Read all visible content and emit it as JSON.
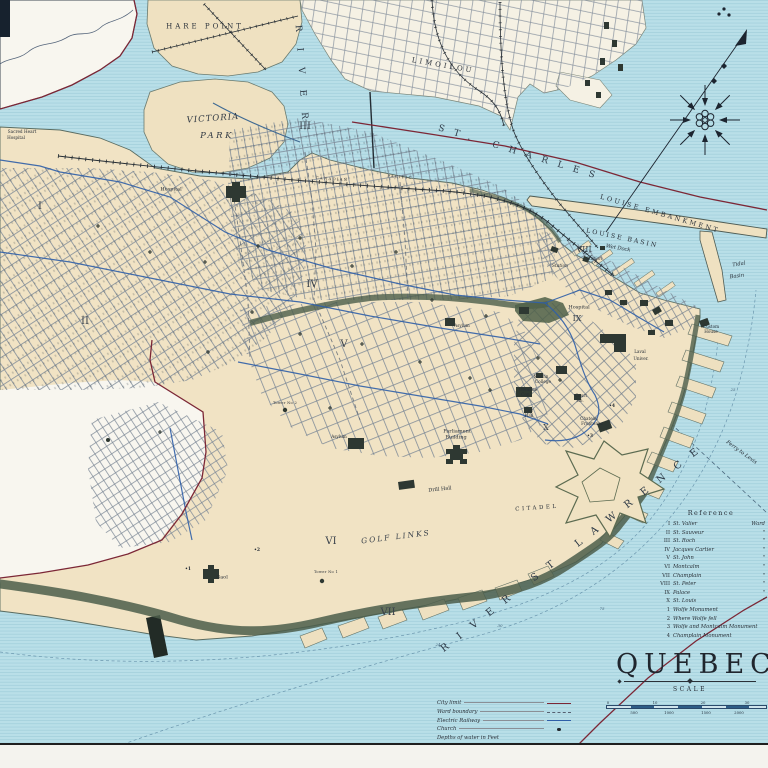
{
  "title": {
    "text": "QUEBEC",
    "scale_label": "SCALE"
  },
  "scale_bar": {
    "top_ticks": [
      "0",
      "10",
      "20",
      "30"
    ],
    "bottom_ticks": [
      "500",
      "1000",
      "1500",
      "2000"
    ]
  },
  "reference": {
    "heading": "Reference",
    "wards": [
      {
        "n": "I",
        "name": "St. Valier",
        "suffix": "Ward"
      },
      {
        "n": "II",
        "name": "St. Sauveur",
        "suffix": "\""
      },
      {
        "n": "III",
        "name": "St. Roch",
        "suffix": "\""
      },
      {
        "n": "IV",
        "name": "Jacques Cartier",
        "suffix": "\""
      },
      {
        "n": "V",
        "name": "St. John",
        "suffix": "\""
      },
      {
        "n": "VI",
        "name": "Montcalm",
        "suffix": "\""
      },
      {
        "n": "VII",
        "name": "Champlain",
        "suffix": "\""
      },
      {
        "n": "VIII",
        "name": "St. Peter",
        "suffix": "\""
      },
      {
        "n": "IX",
        "name": "Palace",
        "suffix": "\""
      },
      {
        "n": "X",
        "name": "St. Louis",
        "suffix": "\""
      }
    ],
    "monuments": [
      {
        "n": "1",
        "name": "Wolfe Monument"
      },
      {
        "n": "2",
        "name": "Where Wolfe fell"
      },
      {
        "n": "3",
        "name": "Wolfe and Montcalm Monument"
      },
      {
        "n": "4",
        "name": "Champlain Monument"
      }
    ]
  },
  "legend": {
    "items": [
      {
        "label": "City limit",
        "type": "city-limit"
      },
      {
        "label": "Ward boundary",
        "type": "ward-boundary"
      },
      {
        "label": "Electric Railway",
        "type": "electric-railway"
      },
      {
        "label": "Church",
        "type": "church"
      },
      {
        "label": "Depths of water in Feet",
        "type": "none"
      }
    ]
  },
  "colors": {
    "water": "#b9dfe8",
    "land": "#f1e3c4",
    "outside_city": "#f8f6ef",
    "electric_railway_blue": "#2f5fa8",
    "city_limit_red": "#7c2736",
    "cliff_green": "#4c5e4b",
    "ink": "#262d36"
  },
  "map": {
    "labels": [
      {
        "name": "hare-point",
        "text": "HARE POINT",
        "x": 205,
        "y": 27,
        "rot": 0,
        "cls": "place-sp"
      },
      {
        "name": "victoria-park-1",
        "text": "VICTORIA",
        "x": 213,
        "y": 119,
        "rot": -4,
        "cls": "place-it"
      },
      {
        "name": "victoria-park-2",
        "text": "PARK",
        "x": 217,
        "y": 136,
        "rot": 0,
        "cls": "place-it2"
      },
      {
        "name": "river-st-charles-1",
        "text": "RIVER",
        "x": 301,
        "y": 80,
        "rot": 86,
        "cls": "water-vert"
      },
      {
        "name": "river-st-charles-2",
        "text": "ST. CHARLES",
        "x": 521,
        "y": 154,
        "rot": 17,
        "cls": "water-lg"
      },
      {
        "name": "river-st-lawrence",
        "text": "RIVER  ST  LAWRENCE",
        "x": 575,
        "y": 547,
        "rot": -38,
        "cls": "water-xl"
      },
      {
        "name": "limoilou",
        "text": "LIMOILOU",
        "x": 443,
        "y": 66,
        "rot": 10,
        "cls": "place-sp"
      },
      {
        "name": "louise-embankment",
        "text": "LOUISE EMBANKMENT",
        "x": 660,
        "y": 214,
        "rot": 16,
        "cls": "embank"
      },
      {
        "name": "louise-basin",
        "text": "LOUISE BASIN",
        "x": 622,
        "y": 239,
        "rot": 12,
        "cls": "basin"
      },
      {
        "name": "wet-dock",
        "text": "Wet Dock",
        "x": 618,
        "y": 249,
        "rot": 10,
        "cls": "sm-it"
      },
      {
        "name": "tidal-basin-1",
        "text": "Tidal",
        "x": 739,
        "y": 265,
        "rot": -8,
        "cls": "sm-it"
      },
      {
        "name": "tidal-basin-2",
        "text": "Basin",
        "x": 737,
        "y": 277,
        "rot": -8,
        "cls": "sm-it"
      },
      {
        "name": "station-1",
        "text": "Station",
        "x": 594,
        "y": 260,
        "rot": 0,
        "cls": "tiny-it"
      },
      {
        "name": "station-2",
        "text": "Station",
        "x": 560,
        "y": 267,
        "rot": 0,
        "cls": "tiny-it"
      },
      {
        "name": "canadian-pacific-1",
        "text": "CANADIAN",
        "x": 332,
        "y": 179,
        "rot": 4,
        "cls": "rail-cap"
      },
      {
        "name": "canadian-pacific-2",
        "text": "PACIFIC",
        "x": 400,
        "y": 177,
        "rot": 4,
        "cls": "rail-cap"
      },
      {
        "name": "hospital-st-sauveur",
        "text": "Hospital",
        "x": 171,
        "y": 190,
        "rot": 0,
        "cls": "bldg"
      },
      {
        "name": "sacred-heart-1",
        "text": "Sacred Heart",
        "x": 22,
        "y": 132,
        "rot": 0,
        "cls": "tiny"
      },
      {
        "name": "sacred-heart-2",
        "text": "Hospital",
        "x": 16,
        "y": 138,
        "rot": 0,
        "cls": "tiny"
      },
      {
        "name": "hospital-ix",
        "text": "Hospital",
        "x": 579,
        "y": 308,
        "rot": 0,
        "cls": "bldg"
      },
      {
        "name": "laval-university-1",
        "text": "Laval",
        "x": 640,
        "y": 352,
        "rot": 0,
        "cls": "tiny"
      },
      {
        "name": "laval-university-2",
        "text": "Univer.",
        "x": 641,
        "y": 359,
        "rot": 0,
        "cls": "tiny"
      },
      {
        "name": "morrin-college-1",
        "text": "Morrin",
        "x": 541,
        "y": 377,
        "rot": 0,
        "cls": "tiny"
      },
      {
        "name": "morrin-college-2",
        "text": "College",
        "x": 543,
        "y": 382,
        "rot": 0,
        "cls": "tiny"
      },
      {
        "name": "ursuline-convent-1",
        "text": "Ursuline",
        "x": 528,
        "y": 390,
        "rot": 0,
        "cls": "tiny"
      },
      {
        "name": "ursuline-convent-2",
        "text": "Con.",
        "x": 526,
        "y": 395,
        "rot": 0,
        "cls": "tiny"
      },
      {
        "name": "city-hall-1",
        "text": "City",
        "x": 529,
        "y": 411,
        "rot": 0,
        "cls": "tiny"
      },
      {
        "name": "city-hall-2",
        "text": "Hall",
        "x": 529,
        "y": 416,
        "rot": 0,
        "cls": "tiny"
      },
      {
        "name": "court-house-1",
        "text": "Court",
        "x": 581,
        "y": 396,
        "rot": 0,
        "cls": "tiny"
      },
      {
        "name": "court-house-2",
        "text": "Ho.",
        "x": 580,
        "y": 401,
        "rot": 0,
        "cls": "tiny"
      },
      {
        "name": "chateau-frontenac-1",
        "text": "Chateau",
        "x": 589,
        "y": 419,
        "rot": 0,
        "cls": "tiny"
      },
      {
        "name": "chateau-frontenac-2",
        "text": "Frontenac",
        "x": 592,
        "y": 424,
        "rot": 0,
        "cls": "tiny"
      },
      {
        "name": "custom-house-1",
        "text": "Custom",
        "x": 711,
        "y": 327,
        "rot": 0,
        "cls": "tiny"
      },
      {
        "name": "custom-house-2",
        "text": "House",
        "x": 711,
        "y": 332,
        "rot": 0,
        "cls": "tiny"
      },
      {
        "name": "parliament-1",
        "text": "Parliament",
        "x": 457,
        "y": 432,
        "rot": 0,
        "cls": "bldg"
      },
      {
        "name": "parliament-2",
        "text": "Building",
        "x": 456,
        "y": 438,
        "rot": 0,
        "cls": "bldg"
      },
      {
        "name": "drill-hall",
        "text": "Drill Hall",
        "x": 440,
        "y": 490,
        "rot": -6,
        "cls": "bldg"
      },
      {
        "name": "golf-links",
        "text": "GOLF LINKS",
        "x": 396,
        "y": 537,
        "rot": -7,
        "cls": "golf"
      },
      {
        "name": "citadel",
        "text": "CITADEL",
        "x": 537,
        "y": 509,
        "rot": -4,
        "cls": "cit"
      },
      {
        "name": "asylum-east",
        "text": "Asylum",
        "x": 462,
        "y": 326,
        "rot": 0,
        "cls": "tiny"
      },
      {
        "name": "asylum-west",
        "text": "Asylum",
        "x": 339,
        "y": 437,
        "rot": 0,
        "cls": "tiny"
      },
      {
        "name": "gaol",
        "text": "Gaol",
        "x": 222,
        "y": 578,
        "rot": 0,
        "cls": "bldg"
      },
      {
        "name": "tower-2",
        "text": "Tower No 2",
        "x": 285,
        "y": 404,
        "rot": 0,
        "cls": "micro"
      },
      {
        "name": "tower-1",
        "text": "Tower No 1",
        "x": 326,
        "y": 573,
        "rot": 0,
        "cls": "micro"
      },
      {
        "name": "ferry-to-levis",
        "text": "Ferry to Levis",
        "x": 741,
        "y": 453,
        "rot": 36,
        "cls": "sm-it"
      },
      {
        "name": "depth-24",
        "text": "24",
        "x": 438,
        "y": 645,
        "rot": 0,
        "cls": "depth"
      },
      {
        "name": "depth-30",
        "text": "30",
        "x": 500,
        "y": 626,
        "rot": 0,
        "cls": "depth"
      },
      {
        "name": "depth-75",
        "text": "75",
        "x": 602,
        "y": 609,
        "rot": 0,
        "cls": "depth"
      },
      {
        "name": "depth-25",
        "text": "25",
        "x": 733,
        "y": 390,
        "rot": 0,
        "cls": "depth"
      },
      {
        "name": "monument-1",
        "text": "•1",
        "x": 188,
        "y": 570,
        "rot": 0,
        "cls": "mon"
      },
      {
        "name": "monument-2",
        "text": "•2",
        "x": 257,
        "y": 551,
        "rot": 0,
        "cls": "mon"
      },
      {
        "name": "monument-3",
        "text": "•3",
        "x": 590,
        "y": 437,
        "rot": 0,
        "cls": "mon"
      },
      {
        "name": "monument-4",
        "text": "•4",
        "x": 612,
        "y": 407,
        "rot": 0,
        "cls": "mon"
      },
      {
        "name": "ward-i",
        "text": "I",
        "x": 40,
        "y": 207,
        "rot": 0,
        "cls": "ward"
      },
      {
        "name": "ward-ii",
        "text": "II",
        "x": 85,
        "y": 322,
        "rot": 0,
        "cls": "ward"
      },
      {
        "name": "ward-iii",
        "text": "III",
        "x": 305,
        "y": 127,
        "rot": 0,
        "cls": "ward"
      },
      {
        "name": "ward-iv",
        "text": "IV",
        "x": 312,
        "y": 285,
        "rot": 0,
        "cls": "ward"
      },
      {
        "name": "ward-v",
        "text": "V",
        "x": 344,
        "y": 345,
        "rot": 0,
        "cls": "ward"
      },
      {
        "name": "ward-vi",
        "text": "VI",
        "x": 331,
        "y": 542,
        "rot": 0,
        "cls": "ward"
      },
      {
        "name": "ward-vii",
        "text": "VII",
        "x": 388,
        "y": 613,
        "rot": 0,
        "cls": "ward"
      },
      {
        "name": "ward-viii",
        "text": "VIII",
        "x": 584,
        "y": 250,
        "rot": 0,
        "cls": "ward-sm"
      },
      {
        "name": "ward-ix",
        "text": "IX",
        "x": 577,
        "y": 319,
        "rot": 0,
        "cls": "ward-sm"
      },
      {
        "name": "ward-x",
        "text": "X",
        "x": 546,
        "y": 428,
        "rot": 0,
        "cls": "ward-sm"
      }
    ]
  }
}
